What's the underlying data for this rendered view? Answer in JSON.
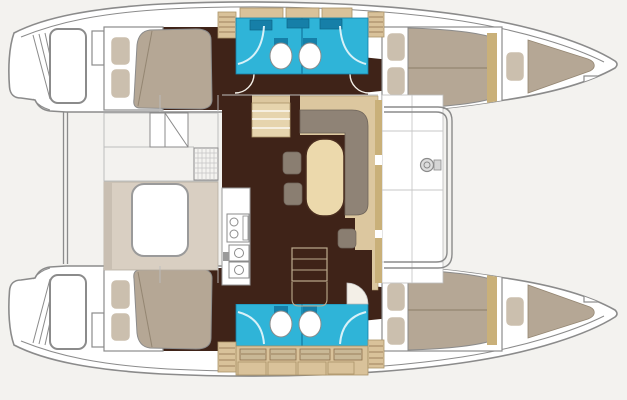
{
  "scene": {
    "label": "catamaran-interior-floor-plan",
    "view": "top-down deck and accommodation plan of a sailing catamaran, bows to the right, sterns to the left",
    "rooms": [
      {
        "name": "port-aft-cabin",
        "type": "cabin",
        "furniture": [
          "double-berth",
          "two-pillows"
        ]
      },
      {
        "name": "port-heads",
        "type": "bathroom",
        "fixtures": [
          "toilet",
          "toilet",
          "shower",
          "shower",
          "vanity-sinks"
        ]
      },
      {
        "name": "port-forward-cabin",
        "type": "cabin",
        "furniture": [
          "double-berth",
          "two-pillows"
        ]
      },
      {
        "name": "port-forepeak-berth",
        "type": "cabin",
        "furniture": [
          "single-berth",
          "one-pillow"
        ]
      },
      {
        "name": "starboard-aft-cabin",
        "type": "cabin",
        "furniture": [
          "double-berth",
          "two-pillows"
        ]
      },
      {
        "name": "starboard-heads",
        "type": "bathroom",
        "fixtures": [
          "toilet",
          "toilet",
          "shower",
          "shower",
          "vanity-lockers"
        ]
      },
      {
        "name": "starboard-forward-cabin",
        "type": "cabin",
        "furniture": [
          "double-berth",
          "two-pillows"
        ]
      },
      {
        "name": "starboard-forepeak-berth",
        "type": "cabin",
        "furniture": [
          "single-berth",
          "one-pillow"
        ]
      },
      {
        "name": "salon",
        "type": "living-area",
        "furniture": [
          "l-shaped-sofa",
          "oval-dining-table",
          "stool",
          "stool",
          "stool",
          "companionway-steps",
          "cabinet"
        ]
      },
      {
        "name": "galley",
        "type": "kitchen",
        "fixtures": [
          "two-burner-stove",
          "sink",
          "sink",
          "faucet"
        ]
      },
      {
        "name": "cockpit",
        "type": "exterior",
        "furniture": [
          "cockpit-table",
          "bench"
        ]
      },
      {
        "name": "foredeck",
        "type": "exterior",
        "fixtures": [
          "windlass-winch",
          "crossbeam"
        ]
      },
      {
        "name": "swim-platforms",
        "type": "exterior",
        "fixtures": [
          "transom-steps",
          "davit-lines"
        ]
      }
    ],
    "counts": {
      "cabins": 4,
      "bathrooms": 2,
      "toilets": 4,
      "berths": 6
    }
  },
  "palette": {
    "bg": "#f3f2ef",
    "hullFill": "#ffffff",
    "line": "#8b8b8b",
    "lineLight": "#bdbdbd",
    "floorDark": "#3f2318",
    "salonBeige": "#dcc79f",
    "stepsBeige": "#e6d4ad",
    "lockerBeige": "#d9c29a",
    "lockerLine": "#8a6f4a",
    "beigeEdge": "#ab9368",
    "khaki": "#c9b079",
    "mattress": "#b5a795",
    "mattressLine": "#948672",
    "pillow": "#cbbfae",
    "sofa": "#8f8376",
    "sofaEdge": "#6f645a",
    "stool": "#8a7e71",
    "tableFill": "#ecd9ac",
    "tableLine": "#4a2d1f",
    "cyan": "#2fb4d8",
    "tealDark": "#167fa8",
    "showerLine": "#d8f1f8",
    "cockpitFloor": "#d9cfc2",
    "benchGrey": "#c9bfb2",
    "arcWhite": "#f3efe7",
    "fittingGrey": "#dddddd"
  }
}
